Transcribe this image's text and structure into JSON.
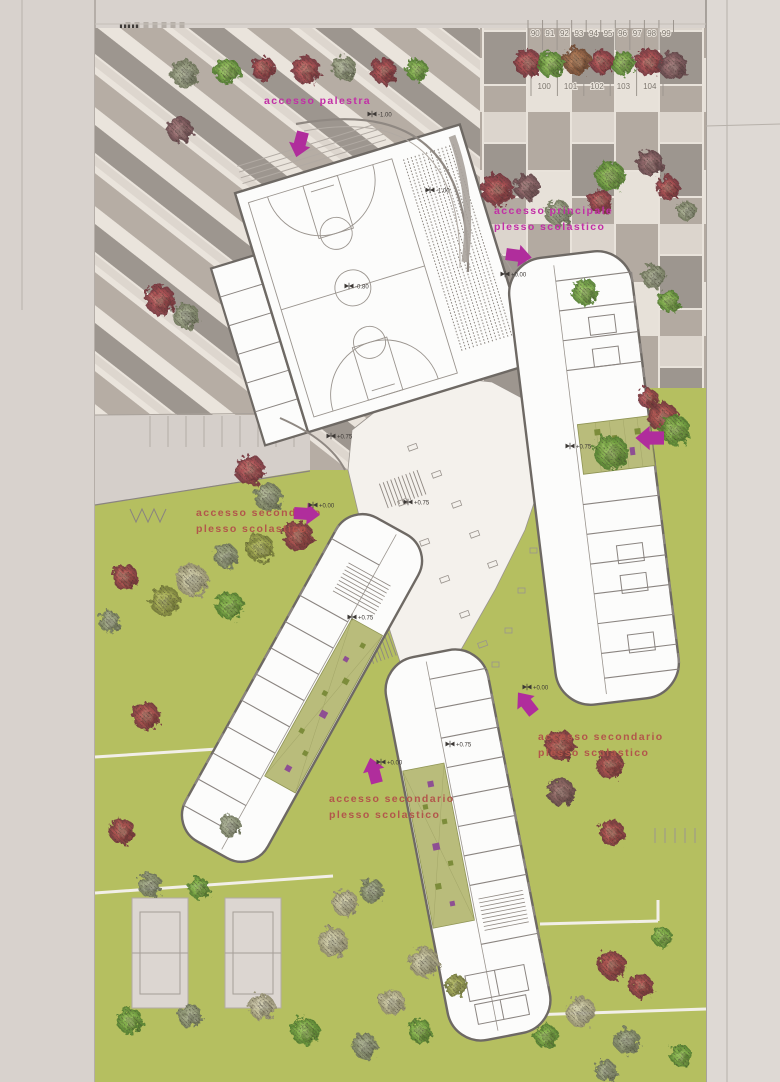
{
  "site": {
    "plan_type": "ground floor site plan - school complex",
    "access_labels": [
      {
        "id": "palestra",
        "lines": [
          "accesso palestra"
        ],
        "x": 264,
        "y": 104,
        "color": "#c22fa6",
        "arrow": {
          "x": 303,
          "y": 132,
          "rot": 105
        }
      },
      {
        "id": "principale",
        "lines": [
          "accesso principale",
          "plesso scolastico"
        ],
        "x": 494,
        "y": 214,
        "color": "#c22fa6",
        "arrow": {
          "x": 506,
          "y": 254,
          "rot": 8
        }
      },
      {
        "id": "secondario-ovest",
        "lines": [
          "accesso secondario",
          "plesso scolastico"
        ],
        "x": 196,
        "y": 516,
        "color": "#b2564b",
        "arrow": {
          "x": 294,
          "y": 513,
          "rot": 4
        }
      },
      {
        "id": "secondario-sud",
        "lines": [
          "accesso secondario",
          "plesso scolastico"
        ],
        "x": 329,
        "y": 802,
        "color": "#b2564b",
        "arrow": {
          "x": 377,
          "y": 783,
          "rot": -105
        }
      },
      {
        "id": "secondario-est",
        "lines": [
          "accesso secondario",
          "plesso scolastico"
        ],
        "x": 538,
        "y": 740,
        "color": "#b2564b",
        "arrow": {
          "x": 534,
          "y": 713,
          "rot": -128
        }
      }
    ],
    "courtyard_arrow": {
      "x": 664,
      "y": 438,
      "rot": 180
    },
    "parking_top": [
      "90",
      "91",
      "92",
      "93",
      "94",
      "95",
      "96",
      "97",
      "98",
      "99"
    ],
    "parking_bottom": [
      "100",
      "101",
      "102",
      "103",
      "104"
    ],
    "elevations": [
      {
        "x": 430,
        "y": 190,
        "t": "-1.00"
      },
      {
        "x": 372,
        "y": 114,
        "t": "-1.00"
      },
      {
        "x": 349,
        "y": 286,
        "t": "-0.80"
      },
      {
        "x": 505,
        "y": 274,
        "t": "+0.00"
      },
      {
        "x": 331,
        "y": 436,
        "t": "+0.75"
      },
      {
        "x": 408,
        "y": 502,
        "t": "+0.75"
      },
      {
        "x": 352,
        "y": 617,
        "t": "+0.75"
      },
      {
        "x": 450,
        "y": 744,
        "t": "+0.75"
      },
      {
        "x": 570,
        "y": 446,
        "t": "+0.75"
      },
      {
        "x": 313,
        "y": 505,
        "t": "+0.00"
      },
      {
        "x": 381,
        "y": 762,
        "t": "+0.00"
      },
      {
        "x": 527,
        "y": 687,
        "t": "+0.00"
      }
    ],
    "colors": {
      "magenta": "#c22fa6",
      "brick": "#b2564b",
      "green": "#b5bf60",
      "plaza_cream": "#eae4dc",
      "paving_taupe": "#b6ada4",
      "paving_gray": "#9d968f",
      "wall": "#6e6964",
      "white": "#fcfcfb",
      "base": "#d8d2cd",
      "court_olive": "#b9bc7b",
      "planter_purple": "#8e4f93",
      "planter_olive": "#7c8c3a"
    },
    "tree_palette": [
      "red",
      "green",
      "sage",
      "olive",
      "pale",
      "rust",
      "grayred"
    ],
    "trees": [
      [
        528,
        63,
        14,
        0
      ],
      [
        551,
        64,
        13,
        1
      ],
      [
        577,
        61,
        14,
        5
      ],
      [
        602,
        62,
        12,
        0
      ],
      [
        623,
        63,
        12,
        1
      ],
      [
        649,
        62,
        14,
        0
      ],
      [
        673,
        66,
        14,
        6
      ],
      [
        185,
        74,
        14,
        2
      ],
      [
        227,
        71,
        13,
        1
      ],
      [
        263,
        68,
        12,
        0
      ],
      [
        306,
        70,
        14,
        0
      ],
      [
        344,
        68,
        12,
        2
      ],
      [
        384,
        71,
        13,
        0
      ],
      [
        417,
        70,
        11,
        1
      ],
      [
        180,
        130,
        13,
        6
      ],
      [
        160,
        300,
        15,
        0
      ],
      [
        186,
        316,
        13,
        2
      ],
      [
        497,
        190,
        16,
        0
      ],
      [
        527,
        187,
        13,
        6
      ],
      [
        558,
        213,
        13,
        2
      ],
      [
        610,
        176,
        15,
        1
      ],
      [
        600,
        201,
        12,
        0
      ],
      [
        650,
        163,
        13,
        6
      ],
      [
        668,
        188,
        12,
        0
      ],
      [
        687,
        211,
        10,
        2
      ],
      [
        585,
        292,
        13,
        1
      ],
      [
        654,
        277,
        12,
        2
      ],
      [
        669,
        301,
        11,
        1
      ],
      [
        648,
        398,
        10,
        0
      ],
      [
        663,
        417,
        15,
        0
      ],
      [
        675,
        430,
        15,
        1
      ],
      [
        611,
        452,
        17,
        1
      ],
      [
        250,
        470,
        15,
        0
      ],
      [
        268,
        497,
        14,
        2
      ],
      [
        298,
        536,
        15,
        0
      ],
      [
        226,
        556,
        12,
        2
      ],
      [
        260,
        548,
        14,
        3
      ],
      [
        192,
        580,
        16,
        4
      ],
      [
        165,
        601,
        15,
        3
      ],
      [
        125,
        577,
        13,
        0
      ],
      [
        230,
        606,
        14,
        1
      ],
      [
        110,
        622,
        11,
        2
      ],
      [
        146,
        716,
        14,
        0
      ],
      [
        122,
        831,
        13,
        0
      ],
      [
        230,
        826,
        11,
        2
      ],
      [
        150,
        885,
        12,
        2
      ],
      [
        199,
        888,
        11,
        1
      ],
      [
        345,
        903,
        13,
        4
      ],
      [
        372,
        891,
        12,
        2
      ],
      [
        333,
        942,
        15,
        4
      ],
      [
        424,
        962,
        15,
        4
      ],
      [
        392,
        1002,
        13,
        4
      ],
      [
        456,
        986,
        11,
        3
      ],
      [
        262,
        1007,
        13,
        4
      ],
      [
        130,
        1021,
        13,
        1
      ],
      [
        190,
        1016,
        12,
        2
      ],
      [
        305,
        1031,
        14,
        1
      ],
      [
        365,
        1046,
        13,
        2
      ],
      [
        420,
        1031,
        12,
        1
      ],
      [
        560,
        745,
        15,
        0
      ],
      [
        610,
        765,
        14,
        0
      ],
      [
        561,
        792,
        14,
        6
      ],
      [
        612,
        833,
        13,
        0
      ],
      [
        612,
        965,
        14,
        0
      ],
      [
        641,
        986,
        12,
        0
      ],
      [
        581,
        1012,
        15,
        4
      ],
      [
        546,
        1036,
        12,
        1
      ],
      [
        627,
        1041,
        13,
        2
      ],
      [
        681,
        1056,
        11,
        1
      ],
      [
        662,
        937,
        10,
        1
      ],
      [
        606,
        1071,
        11,
        2
      ]
    ]
  }
}
